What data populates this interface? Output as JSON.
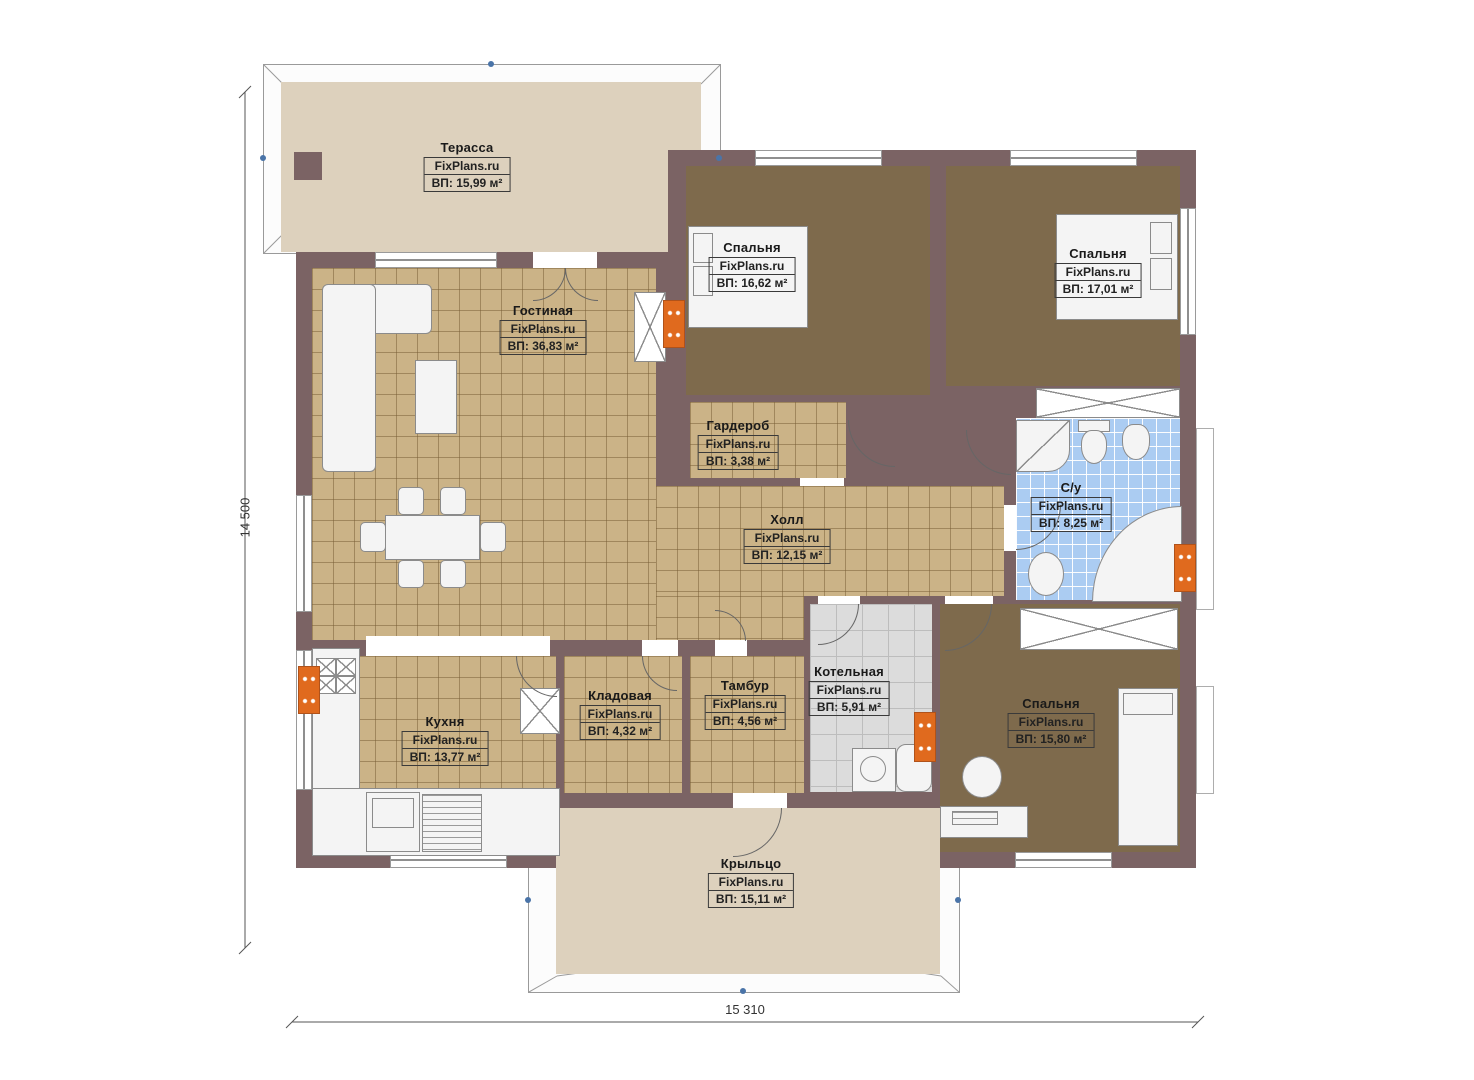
{
  "plan": {
    "watermark": "FixPlans.ru",
    "dimensions": {
      "height_label": "14 500",
      "width_label": "15 310"
    },
    "rooms": [
      {
        "id": "terrace",
        "name": "Терасса",
        "area": "ВП: 15,99 м²"
      },
      {
        "id": "living",
        "name": "Гостиная",
        "area": "ВП: 36,83 м²"
      },
      {
        "id": "bedroom1",
        "name": "Спальня",
        "area": "ВП: 16,62 м²"
      },
      {
        "id": "bedroom2",
        "name": "Спальня",
        "area": "ВП: 17,01 м²"
      },
      {
        "id": "wardrobe",
        "name": "Гардероб",
        "area": "ВП: 3,38 м²"
      },
      {
        "id": "hall",
        "name": "Холл",
        "area": "ВП: 12,15 м²"
      },
      {
        "id": "bathroom",
        "name": "С/у",
        "area": "ВП: 8,25 м²"
      },
      {
        "id": "kitchen",
        "name": "Кухня",
        "area": "ВП: 13,77 м²"
      },
      {
        "id": "storage",
        "name": "Кладовая",
        "area": "ВП: 4,32 м²"
      },
      {
        "id": "vestibule",
        "name": "Тамбур",
        "area": "ВП: 4,56 м²"
      },
      {
        "id": "boiler",
        "name": "Котельная",
        "area": "ВП: 5,91 м²"
      },
      {
        "id": "bedroom3",
        "name": "Спальня",
        "area": "ВП: 15,80 м²"
      },
      {
        "id": "porch",
        "name": "Крыльцо",
        "area": "ВП: 15,11 м²"
      }
    ],
    "colors": {
      "wall": "#7b6364",
      "tile_floor": "#cbb387",
      "carpet_floor": "#7e6a4c",
      "bath_tile": "#abccf2",
      "boiler_tile": "#dcdcdc",
      "terrace_floor": "#ddd1bd",
      "radiator": "#e06a1e",
      "roof_marker": "#4a74a8"
    }
  }
}
